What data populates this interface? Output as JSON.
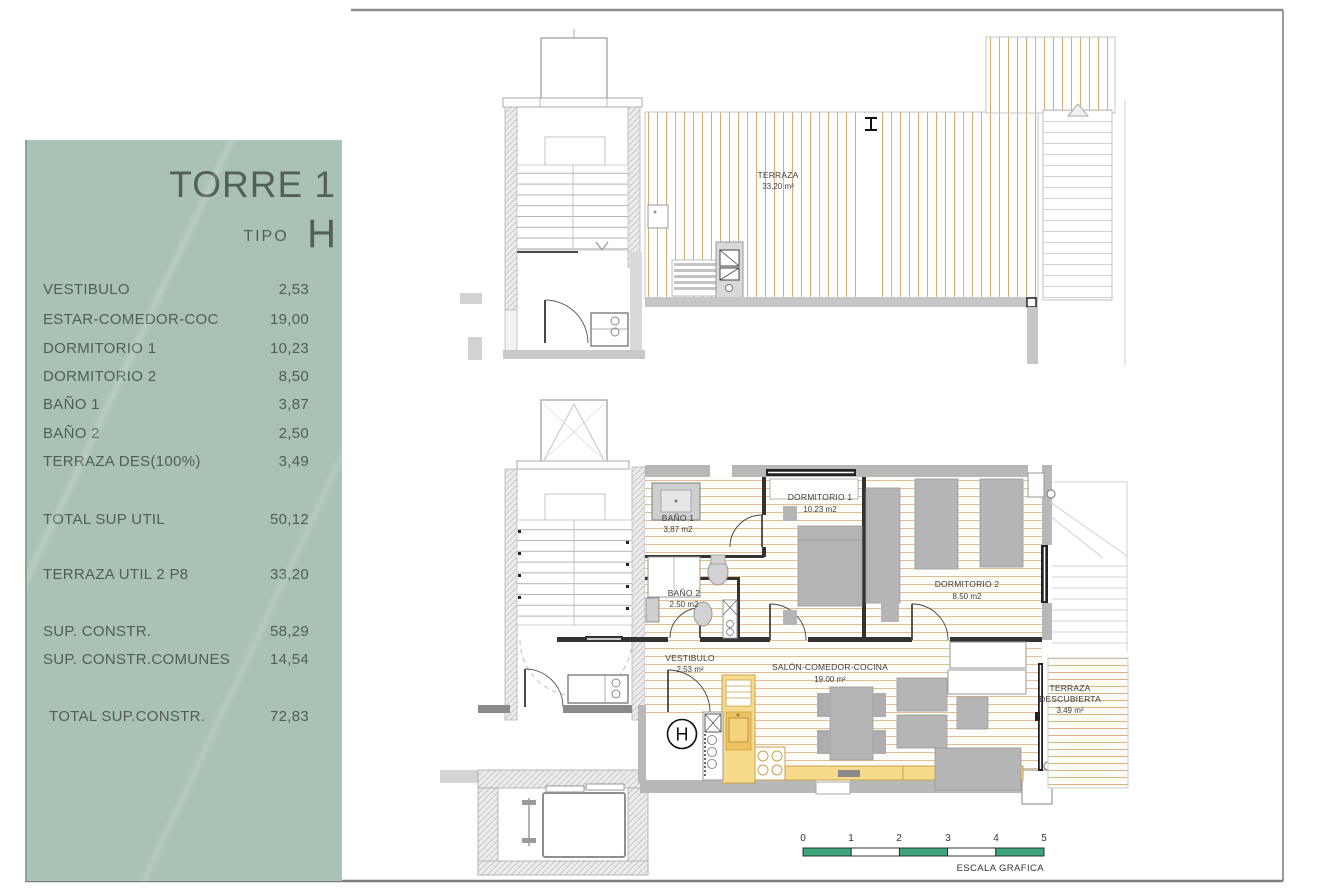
{
  "panel": {
    "title": "TORRE 1",
    "tipo_label": "TIPO",
    "tipo_value": "H",
    "rows": [
      {
        "label": "VESTIBULO",
        "value": "2,53"
      },
      {
        "label": "ESTAR-COMEDOR-COC",
        "value": "19,00"
      },
      {
        "label": "DORMITORIO 1",
        "value": "10,23"
      },
      {
        "label": "DORMITORIO 2",
        "value": "8,50"
      },
      {
        "label": "BAÑO 1",
        "value": "3,87"
      },
      {
        "label": "BAÑO 2",
        "value": "2,50"
      },
      {
        "label": "TERRAZA DES(100%)",
        "value": "3,49"
      }
    ],
    "total_util": {
      "label": "TOTAL SUP UTIL",
      "value": "50,12"
    },
    "terraza_util": {
      "label": "TERRAZA UTIL 2 P8",
      "value": "33,20"
    },
    "sup_constr": {
      "label": "SUP. CONSTR.",
      "value": "58,29"
    },
    "sup_constr_comunes": {
      "label": "SUP. CONSTR.COMUNES",
      "value": "14,54"
    },
    "total_constr": {
      "label": "TOTAL SUP.CONSTR.",
      "value": "72,83"
    }
  },
  "upper_plan": {
    "terraza_label": "TERRAZA",
    "terraza_area": "33,20 m²"
  },
  "lower_plan": {
    "bano1_label": "BAÑO 1",
    "bano1_area": "3,87 m2",
    "dorm1_label": "DORMITORIO 1",
    "dorm1_area": "10.23 m2",
    "bano2_label": "BAÑO 2",
    "bano2_area": "2.50 m2",
    "vestibulo_label": "VESTIBULO",
    "vestibulo_area": "2.53 m²",
    "salon_label": "SALÓN-COMEDOR-COCINA",
    "salon_area": "19.00 m²",
    "dorm2_label": "DORMITORIO 2",
    "dorm2_area": "8.50 m2",
    "terraza_label_1": "TERRAZA",
    "terraza_label_2": "DESCUBIERTA",
    "terraza_area": "3.49 m²",
    "unit_letter": "H"
  },
  "scale_bar": {
    "ticks": [
      "0",
      "1",
      "2",
      "3",
      "4",
      "5"
    ],
    "caption": "ESCALA GRAFICA"
  },
  "colors": {
    "panel_green": "#a9c2b4",
    "scale_green": "#3ea57c",
    "deck_line": "#dcaa76",
    "kitchen_yellow": "#f8da8c",
    "wall_gray": "#b8b8b8"
  }
}
